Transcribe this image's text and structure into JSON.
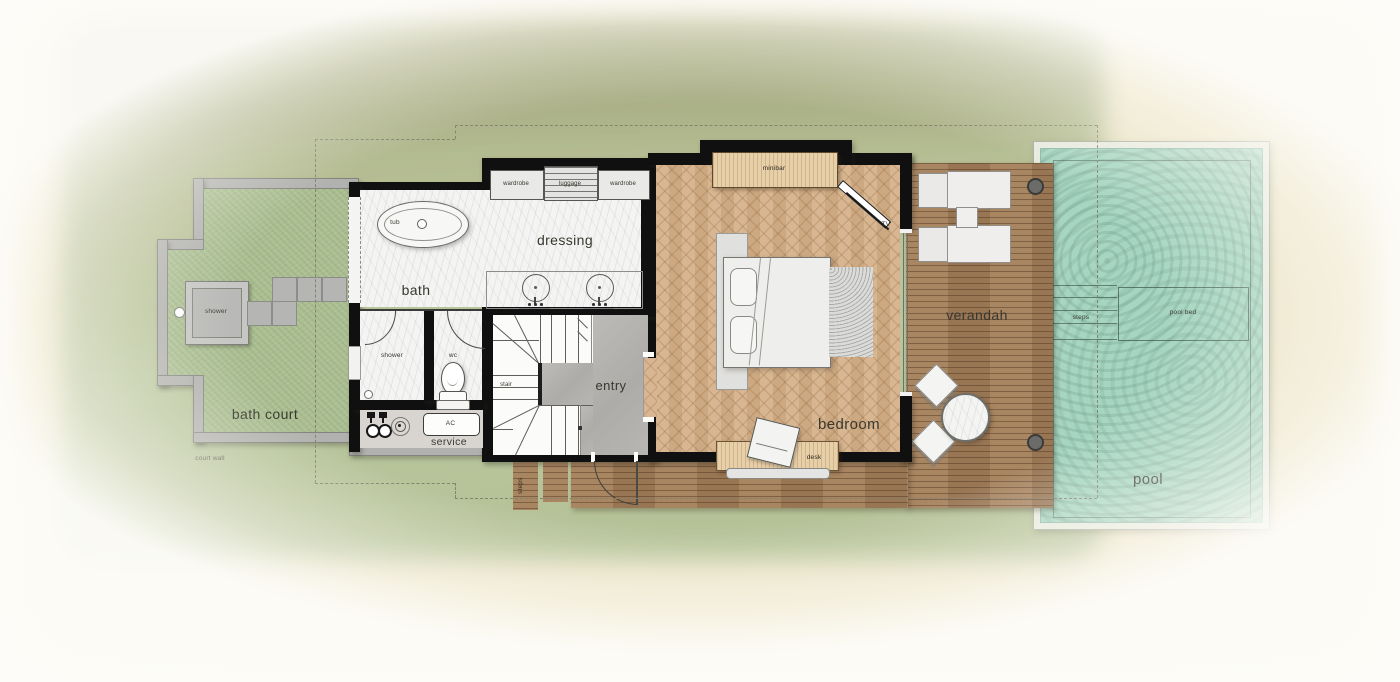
{
  "court": {
    "label": "bath court",
    "wall_label": "court wall",
    "shower_label": "shower"
  },
  "bath": {
    "label": "bath",
    "tub_label": "tub"
  },
  "rooms": {
    "shower_label": "shower",
    "wc_label": "wc",
    "service_label": "service",
    "ac_label": "AC",
    "dressing_label": "dressing",
    "stair_label": "stair",
    "entry_label": "entry"
  },
  "closets": {
    "wardrobe_left": "wardrobe",
    "luggage": "luggage",
    "wardrobe_right": "wardrobe"
  },
  "bedroom": {
    "label": "bedroom",
    "minibar_label": "minibar",
    "tv_label": "TV",
    "desk_label": "desk"
  },
  "outdoor": {
    "verandah_label": "verandah",
    "deck_steps_label": "steps",
    "pool_label": "pool",
    "pool_steps_label": "steps",
    "pool_bed_label": "pool bed"
  },
  "colors": {
    "sand": "#ebe3c5",
    "grass": "#b4c098",
    "court_lawn": "#abbf92",
    "court_wall_gray": "#b1b1af",
    "wall_black": "#101010",
    "marble": "#f4f4f3",
    "concrete": "#b5b3af",
    "herringbone_wood": "#d5b189",
    "deck_wood": "#a47f5a",
    "furniture_wood": "#e7cfa9",
    "pool_water": "#a6d6c2",
    "pool_frame": "#e7eadf",
    "dashed_boundary": "#85836e"
  }
}
